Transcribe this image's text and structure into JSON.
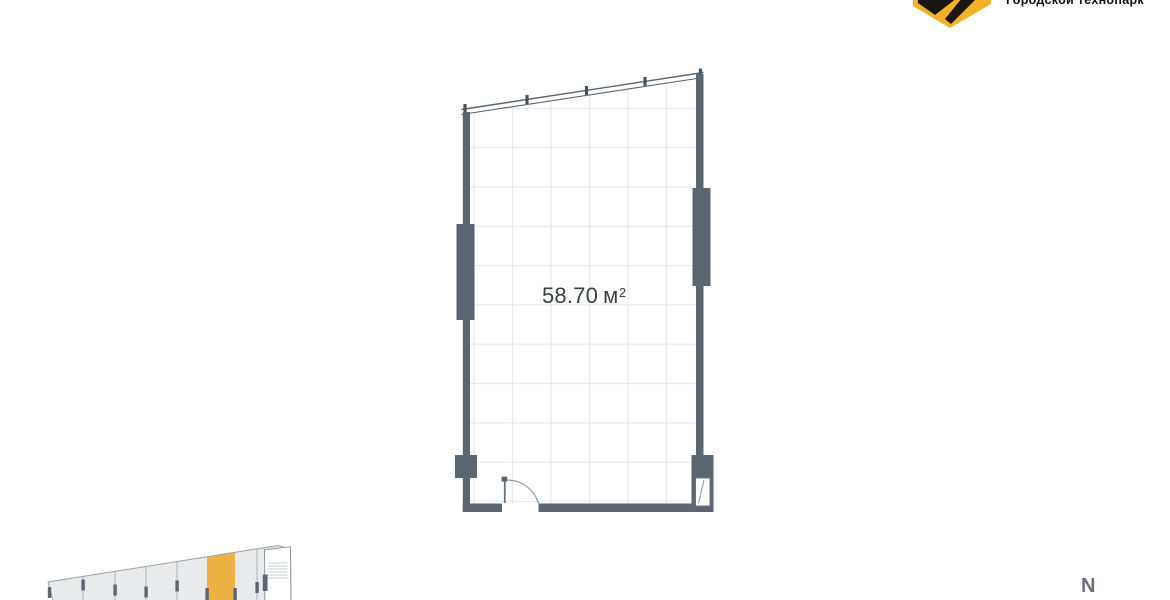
{
  "header": {
    "logo": {
      "text": "Городской технопарк"
    }
  },
  "plan": {
    "area": {
      "value": "58.70",
      "unit": "м",
      "superscript": "2"
    }
  },
  "compass": {
    "north_label": "N"
  },
  "colors": {
    "wall_gray": "#5b6670",
    "accent_yellow": "#ecb243",
    "logo_yellow": "#f2b127",
    "grid_line": "#e9e9e9",
    "minimap_fill": "#e8eaeb"
  }
}
